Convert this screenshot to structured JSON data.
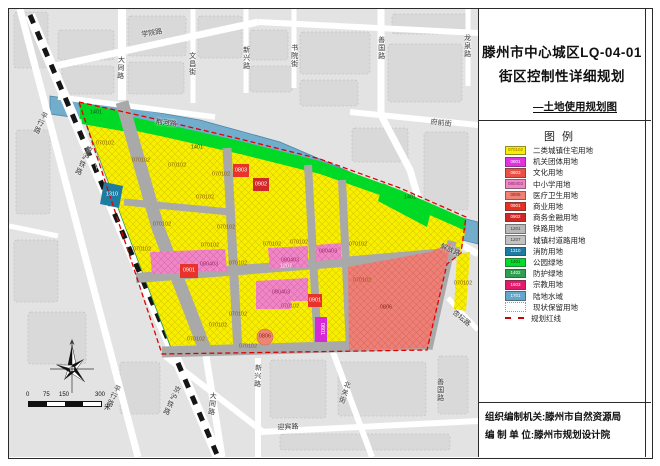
{
  "title_block": {
    "line1": "滕州市中心城区LQ-04-01",
    "line2": "街区控制性详细规划",
    "subtitle": "—土地使用规划图"
  },
  "legend": {
    "header": "图例",
    "items": [
      {
        "code": "070102",
        "label": "二类城镇住宅用地",
        "color": "#f7ef00",
        "text_color": "#8a6a00"
      },
      {
        "code": "0801",
        "label": "机关团体用地",
        "color": "#e032e0"
      },
      {
        "code": "0803",
        "label": "文化用地",
        "color": "#ed4f45"
      },
      {
        "code": "080403",
        "label": "中小学用地",
        "color": "#f186c7",
        "text_color": "#7d2d5f"
      },
      {
        "code": "0806",
        "label": "医疗卫生用地",
        "color": "#ef8177",
        "text_color": "#7c241b"
      },
      {
        "code": "0901",
        "label": "商业用地",
        "color": "#ea2e22"
      },
      {
        "code": "0902",
        "label": "商务金融用地",
        "color": "#d02828"
      },
      {
        "code": "1201",
        "label": "铁路用地",
        "color": "#b9b9b9",
        "text_color": "#3d3d3d"
      },
      {
        "code": "1207",
        "label": "城镇村道路用地",
        "color": "#c2c2c2",
        "text_color": "#3d3d3d"
      },
      {
        "code": "1310",
        "label": "消防用地",
        "color": "#1e7ca2"
      },
      {
        "code": "1401",
        "label": "公园绿地",
        "color": "#00dd2a",
        "text_color": "#0b4d12"
      },
      {
        "code": "1402",
        "label": "防护绿地",
        "color": "#2f9e50"
      },
      {
        "code": "1503",
        "label": "宗教用地",
        "color": "#e31a6a"
      },
      {
        "code": "1701",
        "label": "陆地水域",
        "color": "#64a7cb"
      },
      {
        "code": "",
        "label": "现状保留用地",
        "color": "#ffffff",
        "type": "blank",
        "text_color": "#666666"
      },
      {
        "code": "",
        "label": "规划红线",
        "type": "dash"
      }
    ]
  },
  "credits": {
    "line1": "组织编制机关:滕州市自然资源局",
    "line2": "编 制 单 位:滕州市规划设计院"
  },
  "map": {
    "scale_bar": {
      "ticks": [
        "0",
        "75",
        "150",
        "300"
      ],
      "unit": "米"
    },
    "road_labels": [
      {
        "text": "京沪铁路",
        "x": 90,
        "y": 146,
        "rot": 25,
        "v": true
      },
      {
        "text": "京沪铁路",
        "x": 178,
        "y": 386,
        "rot": 25,
        "v": true
      },
      {
        "text": "平行路",
        "x": 45,
        "y": 112,
        "rot": 25,
        "v": true
      },
      {
        "text": "平行路",
        "x": 118,
        "y": 385,
        "rot": 25,
        "v": true
      },
      {
        "text": "学院路",
        "x": 152,
        "y": 30,
        "rot": -10
      },
      {
        "text": "大同路",
        "x": 121,
        "y": 56,
        "v": true,
        "rot": 3
      },
      {
        "text": "大同路",
        "x": 213,
        "y": 392,
        "v": true,
        "rot": 6
      },
      {
        "text": "文昌街",
        "x": 192,
        "y": 52,
        "v": true
      },
      {
        "text": "新兴路",
        "x": 246,
        "y": 46,
        "v": true
      },
      {
        "text": "新兴路",
        "x": 258,
        "y": 364,
        "v": true,
        "rot": 3
      },
      {
        "text": "书院街",
        "x": 294,
        "y": 44,
        "v": true
      },
      {
        "text": "善国路",
        "x": 381,
        "y": 36,
        "v": true
      },
      {
        "text": "善国路",
        "x": 440,
        "y": 378,
        "v": true
      },
      {
        "text": "龙泉路",
        "x": 467,
        "y": 34,
        "v": true
      },
      {
        "text": "荆河路",
        "x": 166,
        "y": 120,
        "rot": 7
      },
      {
        "text": "府前街",
        "x": 441,
        "y": 120,
        "rot": 6
      },
      {
        "text": "解放路",
        "x": 450,
        "y": 247,
        "rot": 23
      },
      {
        "text": "杏坛路",
        "x": 461,
        "y": 315,
        "rot": 40
      },
      {
        "text": "北关街",
        "x": 348,
        "y": 381,
        "v": true,
        "rot": 18
      },
      {
        "text": "迎宾路",
        "x": 288,
        "y": 424,
        "rot": -2
      }
    ],
    "parcel_labels": [
      {
        "text": "070102",
        "x": 105,
        "y": 144
      },
      {
        "text": "070102",
        "x": 141,
        "y": 161
      },
      {
        "text": "070102",
        "x": 177,
        "y": 166
      },
      {
        "text": "070102",
        "x": 221,
        "y": 175
      },
      {
        "text": "070102",
        "x": 205,
        "y": 198
      },
      {
        "text": "070102",
        "x": 162,
        "y": 225
      },
      {
        "text": "070102",
        "x": 226,
        "y": 228
      },
      {
        "text": "070102",
        "x": 142,
        "y": 250
      },
      {
        "text": "070102",
        "x": 210,
        "y": 246
      },
      {
        "text": "070102",
        "x": 272,
        "y": 245
      },
      {
        "text": "070102",
        "x": 299,
        "y": 243
      },
      {
        "text": "070102",
        "x": 358,
        "y": 245
      },
      {
        "text": "070102",
        "x": 238,
        "y": 264
      },
      {
        "text": "070102",
        "x": 290,
        "y": 307
      },
      {
        "text": "070102",
        "x": 238,
        "y": 315
      },
      {
        "text": "070102",
        "x": 218,
        "y": 326
      },
      {
        "text": "070102",
        "x": 196,
        "y": 340
      },
      {
        "text": "070102",
        "x": 248,
        "y": 347
      },
      {
        "text": "070102",
        "x": 362,
        "y": 281
      },
      {
        "text": "070102",
        "x": 463,
        "y": 284
      },
      {
        "text": "1401",
        "x": 96,
        "y": 113,
        "color": "#0a5c14"
      },
      {
        "text": "1401",
        "x": 197,
        "y": 148,
        "color": "#0a5c14"
      },
      {
        "text": "1401",
        "x": 410,
        "y": 198,
        "color": "#0a5c14"
      },
      {
        "text": "1402",
        "x": 95,
        "y": 164,
        "color": "#ffffff",
        "rot": 70
      },
      {
        "text": "1310",
        "x": 112,
        "y": 195,
        "color": "#ffffff"
      },
      {
        "text": "0803",
        "x": 241,
        "y": 171,
        "color": "#ffffff"
      },
      {
        "text": "0902",
        "x": 261,
        "y": 185,
        "color": "#ffffff"
      },
      {
        "text": "0901",
        "x": 189,
        "y": 271,
        "color": "#ffffff"
      },
      {
        "text": "0901",
        "x": 315,
        "y": 301,
        "color": "#ffffff"
      },
      {
        "text": "0801",
        "x": 321,
        "y": 329,
        "color": "#ffffff",
        "rot": 90
      },
      {
        "text": "080403",
        "x": 209,
        "y": 265,
        "color": "#9c2d6e"
      },
      {
        "text": "080403",
        "x": 290,
        "y": 261,
        "color": "#9c2d6e"
      },
      {
        "text": "080403",
        "x": 328,
        "y": 252,
        "color": "#9c2d6e"
      },
      {
        "text": "080403",
        "x": 281,
        "y": 293,
        "color": "#9c2d6e"
      },
      {
        "text": "0806",
        "x": 386,
        "y": 308,
        "color": "#8a2a20"
      },
      {
        "text": "0806",
        "x": 265,
        "y": 337,
        "color": "#8a2a20"
      },
      {
        "text": "1207",
        "x": 286,
        "y": 267,
        "color": "#f5f5f5"
      }
    ]
  },
  "colors": {
    "residential_yellow": "#f7ef00",
    "park_green": "#00d926",
    "protective_green": "#2f9e50",
    "water_blue": "#72adcc",
    "road_gray": "#a9a9a9",
    "boundary_red": "#e00000",
    "school_pink": "#f186c7",
    "medical_salmon": "#ee7f76",
    "commercial_red": "#ea2e22",
    "fire_teal": "#1e7ca2",
    "government_magenta": "#d52ad5"
  }
}
